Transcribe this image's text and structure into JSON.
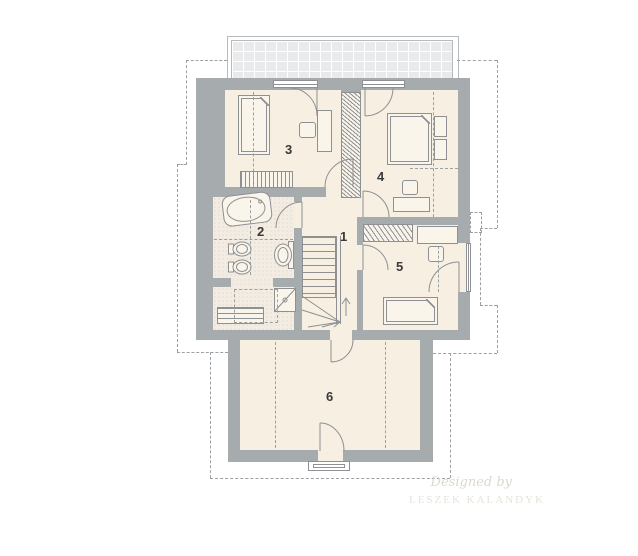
{
  "palette": {
    "wall": "#a6abae",
    "floor": "#f6efe2",
    "tile": "#f3ece2",
    "tile_dot": "#dcd1c0",
    "furn": "#faf5ea",
    "line": "#8e9094",
    "dash": "#9aa0a4",
    "label": "#3a3a3c",
    "terrace": "#e8eaec",
    "terr_border": "#b8bbbe",
    "wm1": "#ddd8d0",
    "wm2": "#e7e3dc"
  },
  "labels": {
    "r1": "1",
    "r2": "2",
    "r3": "3",
    "r4": "4",
    "r5": "5",
    "r6": "6"
  },
  "watermark": {
    "line1": "Designed by",
    "line2": "LESZEK KALANDYK"
  }
}
